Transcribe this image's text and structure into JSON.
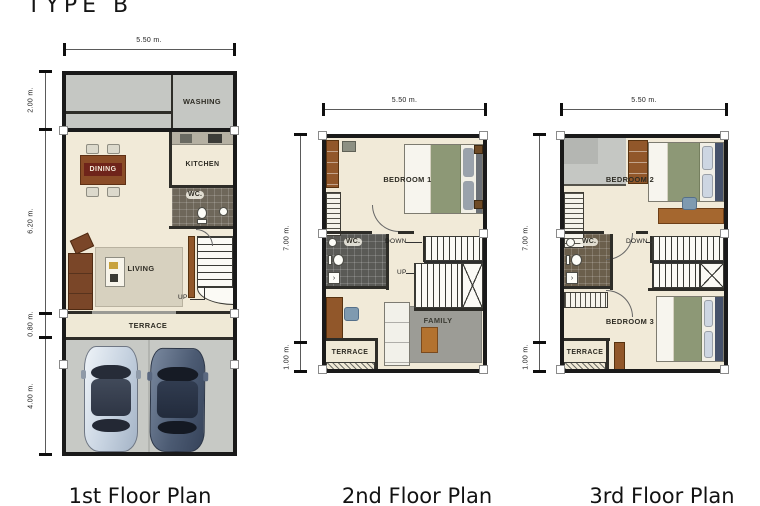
{
  "title": "TYPE B",
  "floor1": {
    "caption": "1st Floor Plan",
    "dim_width": "5.50 m.",
    "left_dims": [
      "2.00 m.",
      "6.20 m.",
      "0.80 m.",
      "4.00 m."
    ],
    "labels": {
      "washing": "WASHING",
      "dining": "DINING",
      "kitchen": "KITCHEN",
      "wc": "WC.",
      "living": "LIVING",
      "up": "UP",
      "terrace": "TERRACE",
      "garage": "GARAGE"
    }
  },
  "floor2": {
    "caption": "2nd Floor Plan",
    "dim_width": "5.50 m.",
    "left_dims": [
      "7.00 m.",
      "1.00 m."
    ],
    "labels": {
      "bedroom1": "BEDROOM 1",
      "wc": "WC.",
      "down": "DOWN",
      "up": "UP",
      "family": "FAMILY",
      "terrace": "TERRACE"
    }
  },
  "floor3": {
    "caption": "3rd Floor Plan",
    "dim_width": "5.50 m.",
    "left_dims": [
      "7.00 m.",
      "1.00 m."
    ],
    "labels": {
      "bedroom2": "BEDROOM 2",
      "wc": "WC.",
      "down": "DOWN",
      "bedroom3": "BEDROOM 3",
      "terrace": "TERRACE"
    }
  },
  "colors": {
    "floor_cream": "#f1ead8",
    "service_gray": "#c5c7c3",
    "wall_black": "#1a1a1a",
    "wood_brown": "#91572a",
    "wc_dark": "#5c5c56",
    "rug_gray": "#9c9c96",
    "blanket_green": "#8d9876",
    "car_light": "#c6d2e0",
    "car_dark": "#4c5b73"
  }
}
